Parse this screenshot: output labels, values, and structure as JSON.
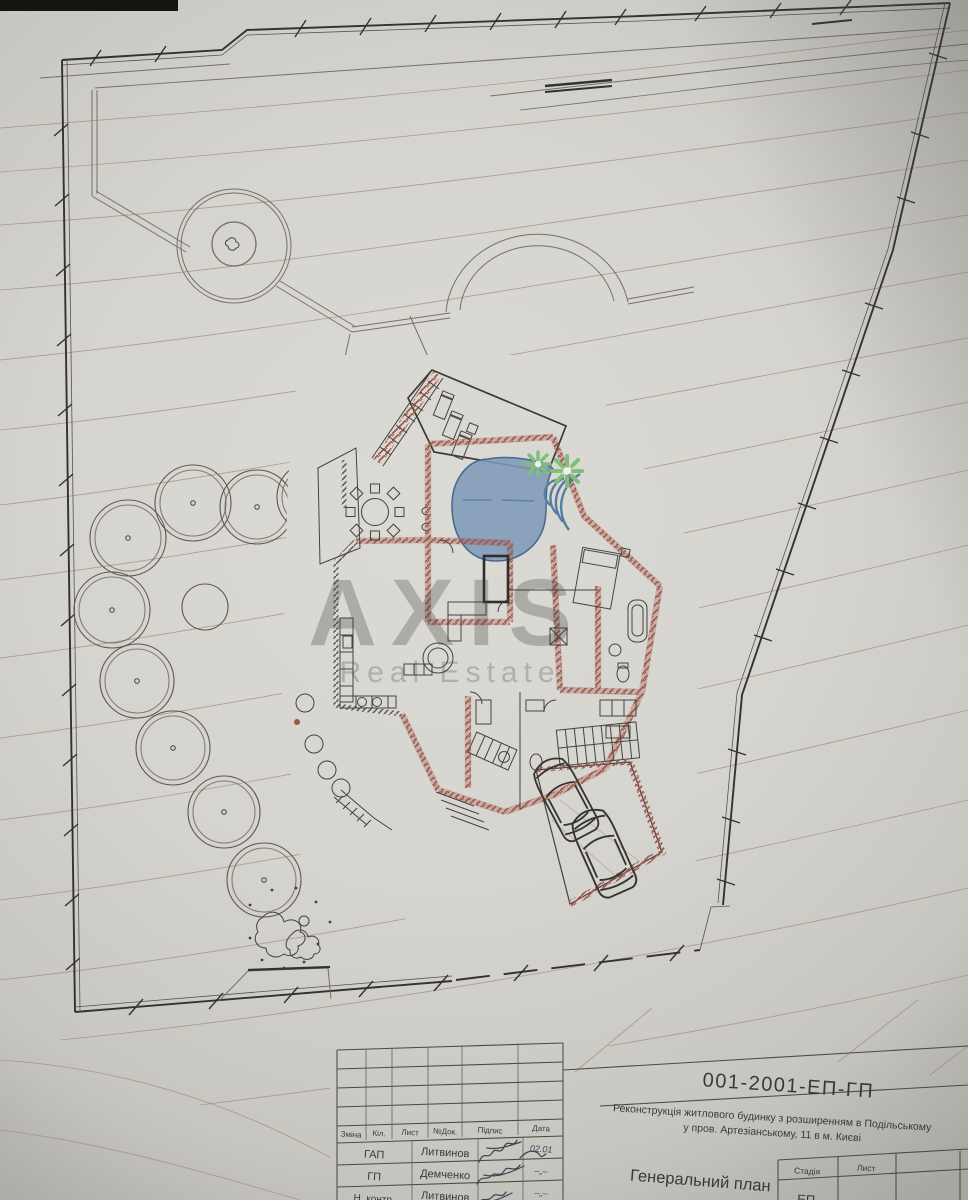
{
  "watermark": {
    "line1": "AXIS",
    "line2": "Real Estate"
  },
  "drawing": {
    "type": "site-plan-photo",
    "features": {
      "tree_canopies": 9,
      "cars": 2,
      "pools": 1,
      "dwellings": 1
    },
    "colors": {
      "paper": "#d6d4ce",
      "ink": "#3f3e3a",
      "walls_red": "#9c5449",
      "pool_blue": "#7e9ab8",
      "plant_green": "#7fbf77",
      "contour": "#96907e"
    }
  },
  "title_block": {
    "code": "001-2001-ЕП-ГП",
    "project_line1": "Реконструкція житлового будинку з розширенням в Подільському",
    "project_line2": "у пров. Артезіанському, 11 в м. Києві",
    "drawing_title": "Генеральний план",
    "columns": [
      "Зміна",
      "Кіл.",
      "Лист",
      "№Док.",
      "Підпис",
      "Дата"
    ],
    "rows": [
      {
        "role": "ГАП",
        "name": "Литвинов",
        "date": "02.01"
      },
      {
        "role": "ГП",
        "name": "Демченко",
        "date": "–„–"
      },
      {
        "role": "Н. контр.",
        "name": "Литвинов",
        "date": "–„–"
      }
    ],
    "stage_label": "Стадія",
    "sheet_label": "Лист",
    "stage_value": "ЕП"
  }
}
